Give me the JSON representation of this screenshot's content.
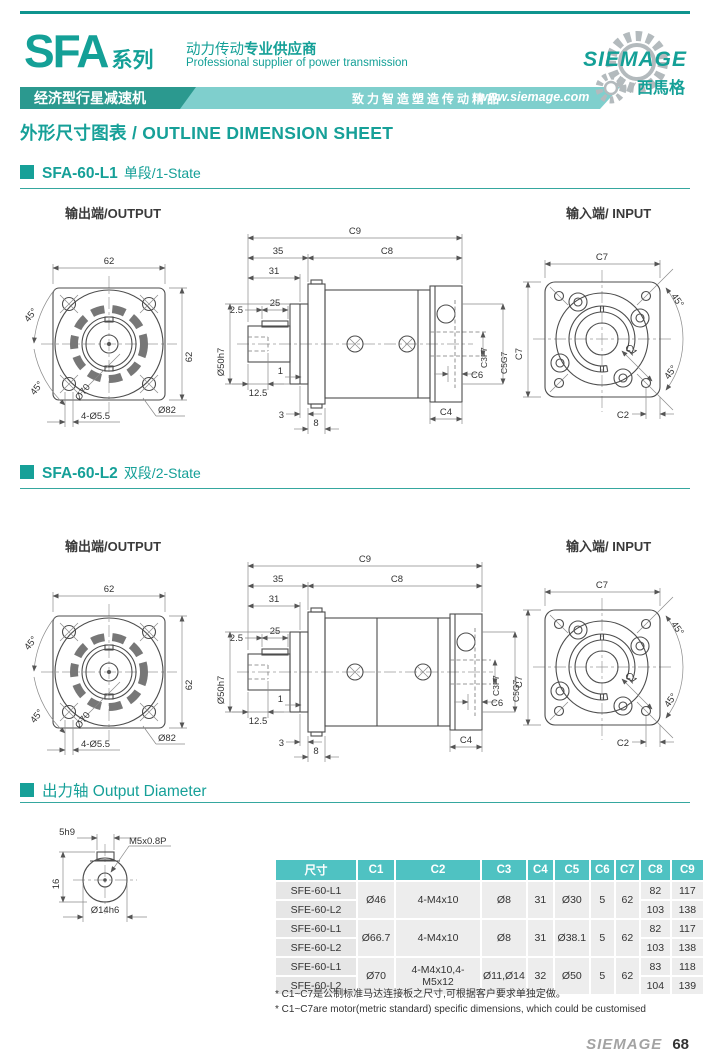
{
  "header": {
    "series": "SFA",
    "series_suffix": "系列",
    "banner": "经济型行星减速机",
    "tagline_cn_regular": "动力传动",
    "tagline_cn_bold": "专业供应商",
    "tagline_en": "Professional supplier of power transmission",
    "slogan": "致力智造塑造传动精品",
    "website": "www.siemage.com",
    "brand": "SIEMAGE",
    "brand_cn": "西馬格"
  },
  "page_title": "外形尺寸图表 / OUTLINE DIMENSION SHEET",
  "sections": [
    {
      "model": "SFA-60-L1",
      "stage": "单段/1-State",
      "output_label": "输出端/OUTPUT",
      "input_label": "输入端/ INPUT"
    },
    {
      "model": "SFA-60-L2",
      "stage": "双段/2-State",
      "output_label": "输出端/OUTPUT",
      "input_label": "输入端/ INPUT"
    }
  ],
  "dims": {
    "c1": "C1",
    "c2": "C2",
    "c3": "C3F7",
    "c4": "C4",
    "c5": "C5G7",
    "c6": "C6",
    "c7": "C7",
    "c8": "C8",
    "c9": "C9",
    "flange_w": "62",
    "flange_h": "62",
    "angle45": "45°",
    "bolt_circle": "Ø70",
    "mount_holes": "4-Ø5.5",
    "body_od": "Ø82",
    "shaft_boss": "Ø50h7",
    "len35": "35",
    "len31": "31",
    "len25": "25",
    "len2_5": "2.5",
    "len12_5": "12.5",
    "len1": "1",
    "len3": "3",
    "len8": "8"
  },
  "output_shaft": {
    "title": "出力轴 Output Diameter",
    "key_width": "5h9",
    "thread": "M5x0.8P",
    "height": "16",
    "diameter": "Ø14h6"
  },
  "table": {
    "headers": [
      "尺寸",
      "C1",
      "C2",
      "C3",
      "C4",
      "C5",
      "C6",
      "C7",
      "C8",
      "C9"
    ],
    "groups": [
      {
        "c1": "Ø46",
        "c2": "4-M4x10",
        "c3": "Ø8",
        "c4": "31",
        "c5": "Ø30",
        "c6": "5",
        "c7": "62",
        "rows": [
          {
            "model": "SFE-60-L1",
            "c8": "82",
            "c9": "117"
          },
          {
            "model": "SFE-60-L2",
            "c8": "103",
            "c9": "138"
          }
        ]
      },
      {
        "c1": "Ø66.7",
        "c2": "4-M4x10",
        "c3": "Ø8",
        "c4": "31",
        "c5": "Ø38.1",
        "c6": "5",
        "c7": "62",
        "rows": [
          {
            "model": "SFE-60-L1",
            "c8": "82",
            "c9": "117"
          },
          {
            "model": "SFE-60-L2",
            "c8": "103",
            "c9": "138"
          }
        ]
      },
      {
        "c1": "Ø70",
        "c2": "4-M4x10,4-M5x12",
        "c3": "Ø11,Ø14",
        "c4": "32",
        "c5": "Ø50",
        "c6": "5",
        "c7": "62",
        "rows": [
          {
            "model": "SFE-60-L1",
            "c8": "83",
            "c9": "118"
          },
          {
            "model": "SFE-60-L2",
            "c8": "104",
            "c9": "139"
          }
        ]
      }
    ],
    "footnotes": [
      "* C1~C7是公制标准马达连接板之尺寸,可根据客户要求单独定做。",
      "* C1~C7are motor(metric standard)  specific dimensions, which could be customised"
    ]
  },
  "footer": {
    "brand": "SIEMAGE",
    "page": "68"
  },
  "colors": {
    "teal": "#16a098",
    "teal_dark": "#2b998f",
    "teal_light": "#7fcfcd",
    "table_header": "#4fc2c2"
  }
}
